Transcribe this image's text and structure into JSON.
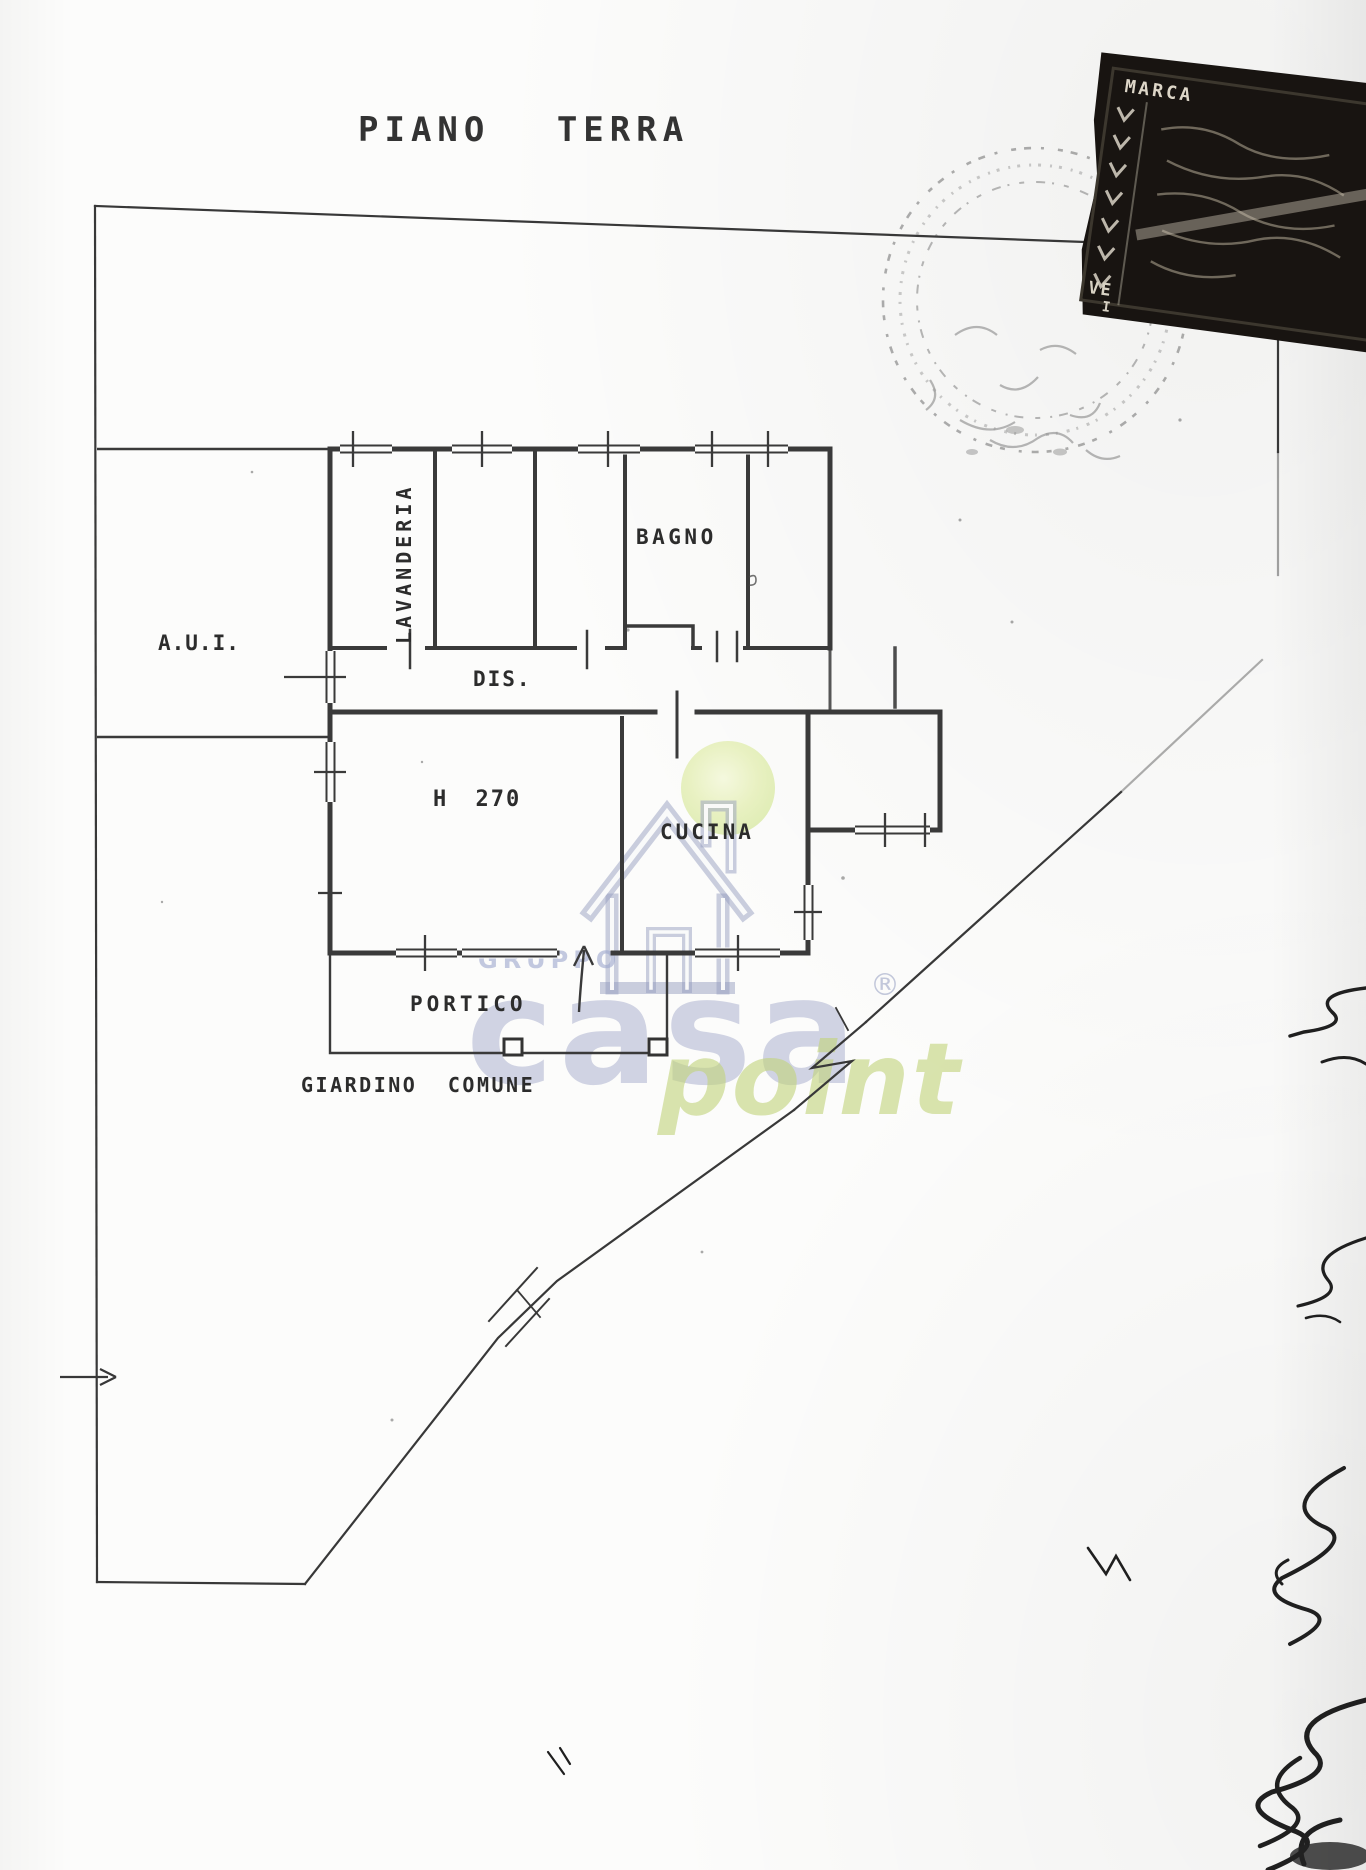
{
  "document": {
    "title": "PIANO TERRA",
    "rooms": {
      "aui": "A.U.I.",
      "lavanderia": "LAVANDERIA",
      "bagno": "BAGNO",
      "dis": "DIS.",
      "h270": "H 270",
      "cucina": "CUCINA",
      "portico": "PORTICO",
      "giardino": "GIARDINO COMUNE"
    },
    "ink_color": "#3a3a3a"
  },
  "watermark": {
    "gruppo": "GRUPPO",
    "casa": "casa",
    "registered": "®",
    "point": "point",
    "house_icon": "house-with-chimney",
    "colors": {
      "blue": "#939cc2",
      "green": "#cbdd8e",
      "circle": "#e3efb6"
    }
  },
  "stamps": {
    "revenue": {
      "word1": "MARCA",
      "word2": "VE",
      "word3": "I"
    },
    "round_stamp": "illegible"
  }
}
